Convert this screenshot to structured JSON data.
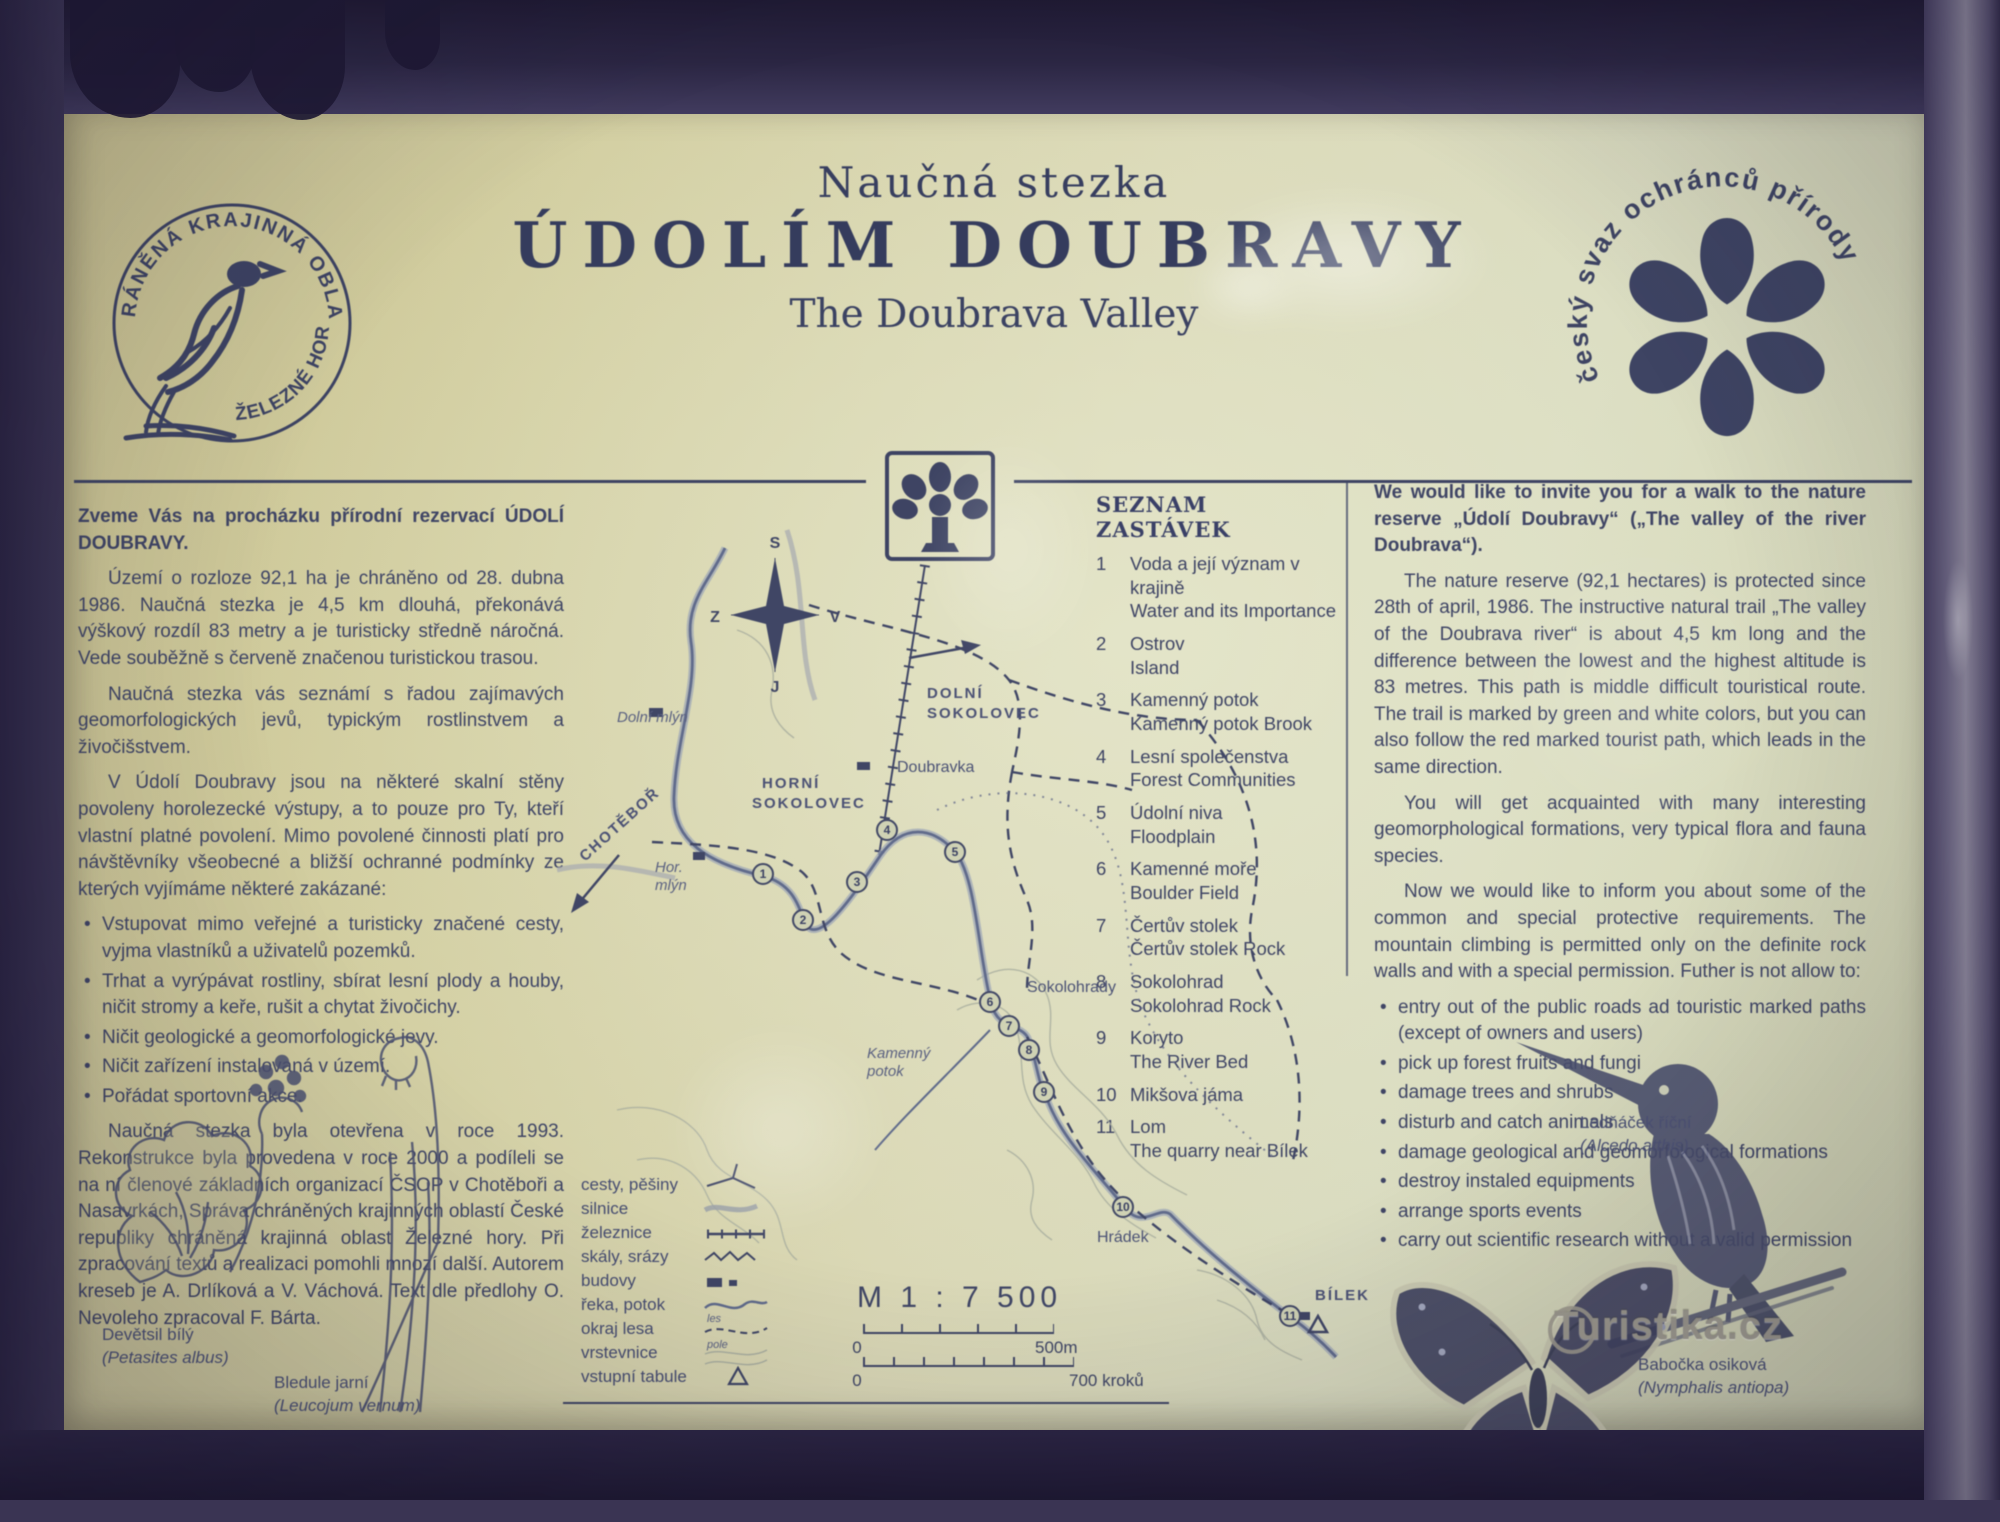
{
  "header": {
    "kicker": "Naučná stezka",
    "title": "ÚDOLÍM DOUBRAVY",
    "subtitle": "The Doubrava Valley"
  },
  "seal": {
    "ring_top": "CHRÁNĚNÁ KRAJINNÁ OBLAST",
    "ring_bottom": "• ŽELEZNÉ HORY"
  },
  "csop": {
    "arc_text": "český svaz ochránců přírody"
  },
  "left_column": {
    "intro": "Zveme Vás na procházku přírodní rezervací ÚDOLÍ DOUBRAVY.",
    "p1": "Území o rozloze 92,1 ha je chráněno od 28. dubna 1986. Naučná stezka je 4,5 km dlouhá, překonává výškový rozdíl 83 metry a je turisticky středně náročná. Vede souběžně s červeně značenou turistickou trasou.",
    "p2": "Naučná stezka vás seznámí s řadou zajímavých geomorfologických jevů, typickým rostlinstvem a živočišstvem.",
    "p3": "V Údolí Doubravy jsou na některé skalní stěny povoleny horolezecké výstupy, a to pouze pro Ty, kteří vlastní platné povolení. Mimo povolené činnosti platí pro návštěvníky všeobecné a bližší ochranné podmínky ze kterých vyjímáme některé zakázané:",
    "bullets": [
      "Vstupovat mimo veřejné a turisticky značené cesty, vyjma vlastníků a uživatelů pozemků.",
      "Trhat a vyrýpávat rostliny, sbírat lesní plody a houby, ničit stromy a keře, rušit a chytat živočichy.",
      "Ničit geologické a geomorfologické jevy.",
      "Ničit zařízení instalovaná v území.",
      "Pořádat sportovní akce."
    ],
    "closing": "Naučná stezka byla otevřena v roce 1993. Rekonstrukce byla provedena v roce 2000 a podíleli se na ní členové základních organizací ČSOP v Chotěboři a Nasavrkách, Správa chráněných krajinných oblastí České republiky chráněná krajinná oblast Železné hory. Při zpracování textů a realizaci pomohli mnozí další. Autorem kreseb je A. Drlíková a V. Váchová. Text dle předlohy O. Nevoleho zpracoval F. Bárta."
  },
  "stops": {
    "heading": "SEZNAM ZASTÁVEK",
    "items": [
      {
        "num": "1",
        "cz": "Voda a její význam v krajině",
        "en": "Water and its Importance"
      },
      {
        "num": "2",
        "cz": "Ostrov",
        "en": "Island"
      },
      {
        "num": "3",
        "cz": "Kamenný potok",
        "en": "Kamenný potok Brook"
      },
      {
        "num": "4",
        "cz": "Lesní společenstva",
        "en": "Forest Communities"
      },
      {
        "num": "5",
        "cz": "Údolní niva",
        "en": "Floodplain"
      },
      {
        "num": "6",
        "cz": "Kamenné moře",
        "en": "Boulder Field"
      },
      {
        "num": "7",
        "cz": "Čertův stolek",
        "en": "Čertův stolek Rock"
      },
      {
        "num": "8",
        "cz": "Sokolohrad",
        "en": "Sokolohrad Rock"
      },
      {
        "num": "9",
        "cz": "Koryto",
        "en": "The River Bed"
      },
      {
        "num": "10",
        "cz": "Mikšova jáma",
        "en": ""
      },
      {
        "num": "11",
        "cz": "Lom",
        "en": "The quarry near Bílek"
      }
    ]
  },
  "right_column": {
    "lead": "We would like to invite you for a walk to the nature reserve „Údolí Doubravy“ („The valley of the river Doubrava“).",
    "p1": "The nature reserve (92,1 hectares) is protected since 28th of april, 1986. The instructive natural trail „The valley of the Doubrava river“ is about 4,5 km long and the difference between the lowest and the highest altitude is 83 metres. This path is middle difficult touristical route. The trail is marked by green and white colors, but you can also follow the red marked tourist path, which leads in the same direction.",
    "p2": "You will get acquainted with many interesting geomorphological formations, very typical flora and fauna species.",
    "p3": "Now we would like to inform you about some of the common and special protective requirements. The mountain climbing is permitted only on the definite rock walls and with a special permission. Futher is not allow to:",
    "bullets": [
      "entry out of the public roads ad touristic marked paths (except of owners and users)",
      "pick up forest fruits and fungi",
      "damage trees and shrubs",
      "disturb and catch animals",
      "damage geological and geomorfological formations",
      "destroy instaled equipments",
      "arrange sports events",
      "carry out scientific research without a valid permission"
    ]
  },
  "map": {
    "compass": {
      "n": "S",
      "w": "Z",
      "e": "V",
      "s": "J"
    },
    "labels": {
      "dolni_mlyn": "Dolní mlýn",
      "dolni_sokolovec_1": "DOLNÍ",
      "dolni_sokolovec_2": "SOKOLOVEC",
      "doubravka": "Doubravka",
      "horni_sokolovec_1": "HORNÍ",
      "horni_sokolovec_2": "SOKOLOVEC",
      "chotebor": "CHOTĚBOŘ",
      "hor_mlyn_1": "Hor.",
      "hor_mlyn_2": "mlýn",
      "sokolohrady": "Sokolohrady",
      "kamenny_potok_1": "Kamenný",
      "kamenny_potok_2": "potok",
      "hradek": "Hrádek",
      "bilek": "BÍLEK"
    },
    "stop_numbers": [
      "1",
      "2",
      "3",
      "4",
      "5",
      "6",
      "7",
      "8",
      "9",
      "10",
      "11"
    ],
    "legend": {
      "items": [
        "cesty, pěšiny",
        "silnice",
        "železnice",
        "skály, srázy",
        "budovy",
        "řeka, potok",
        "okraj lesa",
        "vrstevnice",
        "vstupní tabule"
      ],
      "les": "les",
      "pole": "pole"
    },
    "scale": {
      "ratio": "M 1 : 7 500",
      "zero": "0",
      "end_m": "500m",
      "end_steps": "700 kroků"
    }
  },
  "captions": {
    "petasites_cz": "Devětsil bílý",
    "petasites_lat": "(Petasites albus)",
    "leucojum_cz": "Bledule jarní",
    "leucojum_lat": "(Leucojum vernum)",
    "kingfisher_cz": "Ledňáček říční",
    "kingfisher_lat": "(Alcedo atthis)",
    "butterfly_cz": "Babočka osiková",
    "butterfly_lat": "(Nymphalis antiopa)"
  },
  "watermark": {
    "text": "Turistika.cz"
  },
  "colors": {
    "board": "#d6d2a8",
    "ink": "#3e4569",
    "frame": "#352f4d",
    "map_water": "#5f6b8e",
    "map_contour": "#a9ae9e"
  }
}
